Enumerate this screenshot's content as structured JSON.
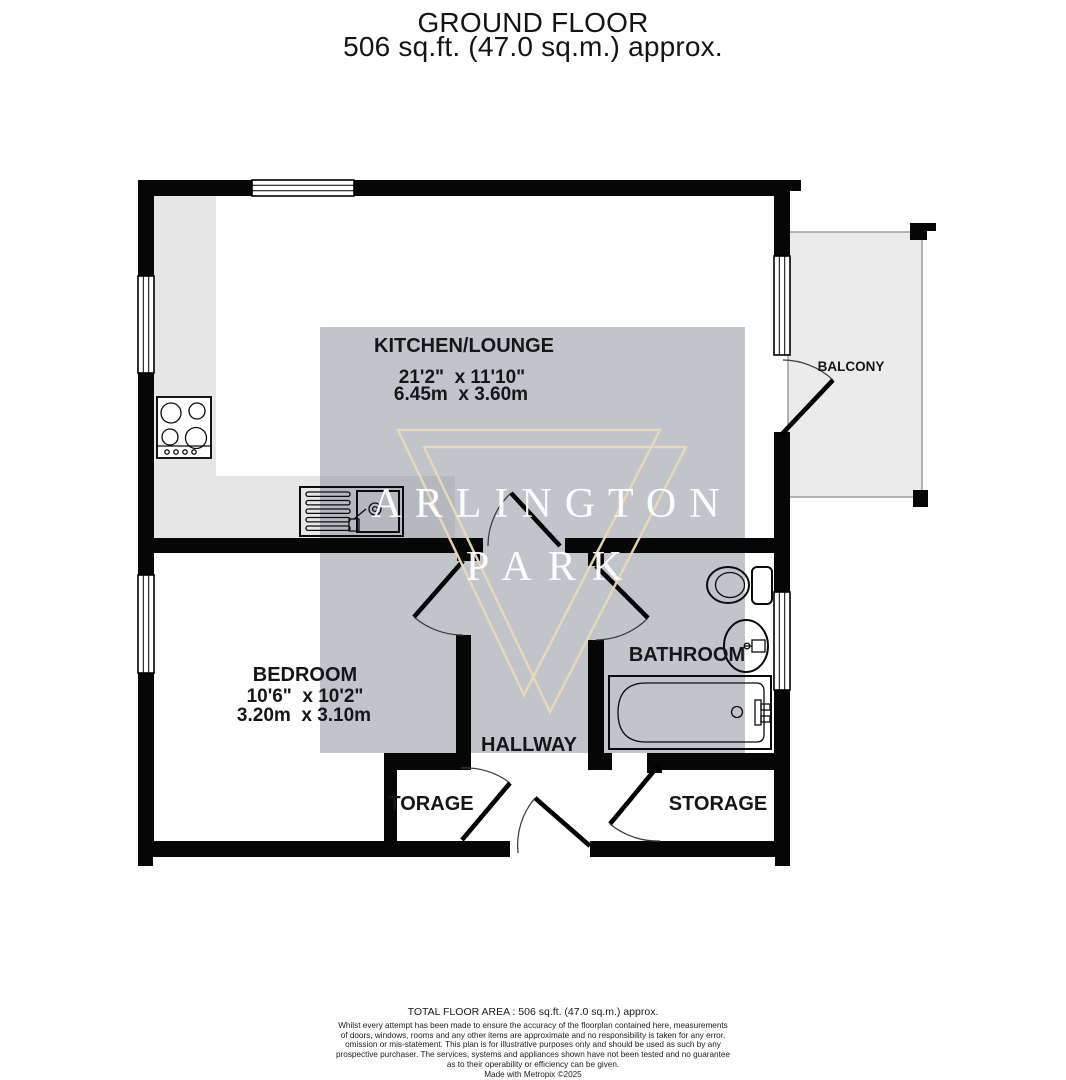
{
  "title": {
    "line1": "GROUND FLOOR",
    "line2": "506 sq.ft. (47.0 sq.m.) approx."
  },
  "watermark": {
    "line1": "ARLINGTON",
    "line2": "PARK"
  },
  "rooms": {
    "kitchen_lounge": {
      "name": "KITCHEN/LOUNGE",
      "dims_imperial": "21'2\"  x 11'10\"",
      "dims_metric": "6.45m  x 3.60m"
    },
    "bedroom": {
      "name": "BEDROOM",
      "dims_imperial": "10'6\"  x 10'2\"",
      "dims_metric": "3.20m  x 3.10m"
    },
    "bathroom": {
      "name": "BATHROOM"
    },
    "hallway": {
      "name": "HALLWAY"
    },
    "storage_left": {
      "name": "TORAGE"
    },
    "storage_right": {
      "name": "STORAGE"
    },
    "balcony": {
      "name": "BALCONY"
    }
  },
  "footer": {
    "total_area": "TOTAL FLOOR AREA : 506 sq.ft. (47.0 sq.m.) approx.",
    "disclaimer": [
      "Whilst every attempt has been made to ensure the accuracy of the floorplan contained here, measurements",
      "of doors, windows, rooms and any other items are approximate and no responsibility is taken for any error,",
      "omission or mis-statement. This plan is for illustrative purposes only and should be used as such by any",
      "prospective purchaser. The services, systems and appliances shown have not been tested and no guarantee",
      "as to their operability or efficiency can be given."
    ],
    "credit": "Made with Metropix ©2025"
  },
  "colors": {
    "wall": "#060606",
    "counter_gray": "#e6e6e6",
    "balcony_gray": "#ebebeb",
    "watermark_overlay": "#898e9b",
    "watermark_triangle": "#ead9b5",
    "watermark_text": "#ffffff",
    "label_text": "#161616"
  }
}
